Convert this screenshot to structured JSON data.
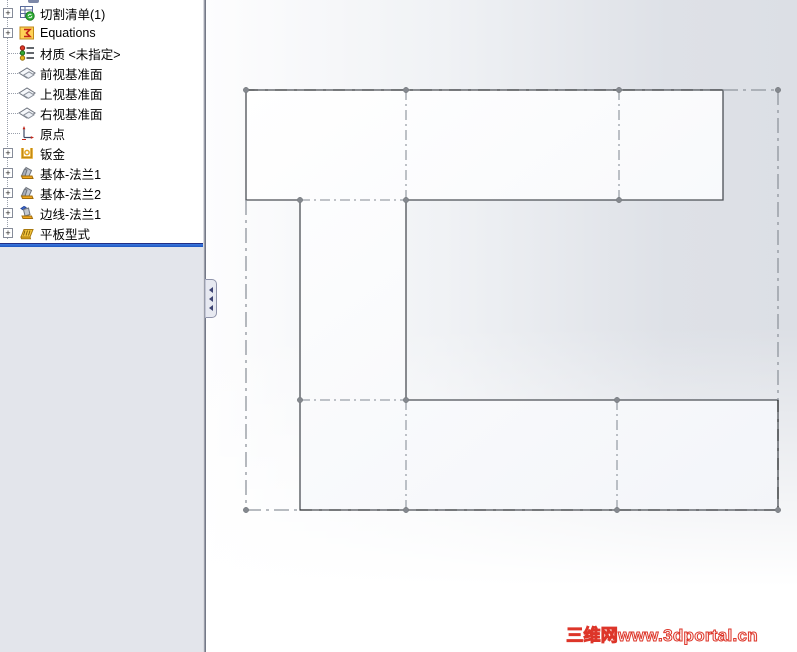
{
  "sidebar": {
    "expander_glyph": "+",
    "items": [
      {
        "label": "切割清单(1)",
        "icon": "cut-list-icon",
        "expandable": true
      },
      {
        "label": "Equations",
        "icon": "equations-icon",
        "expandable": true
      },
      {
        "label": "材质 <未指定>",
        "icon": "material-icon",
        "expandable": false
      },
      {
        "label": "前视基准面",
        "icon": "plane-icon",
        "expandable": false
      },
      {
        "label": "上视基准面",
        "icon": "plane-icon",
        "expandable": false
      },
      {
        "label": "右视基准面",
        "icon": "plane-icon",
        "expandable": false
      },
      {
        "label": "原点",
        "icon": "origin-icon",
        "expandable": false
      },
      {
        "label": "钣金",
        "icon": "sheet-metal-icon",
        "expandable": true
      },
      {
        "label": "基体-法兰1",
        "icon": "base-flange-icon",
        "expandable": true
      },
      {
        "label": "基体-法兰2",
        "icon": "base-flange-icon",
        "expandable": true
      },
      {
        "label": "边线-法兰1",
        "icon": "edge-flange-icon",
        "expandable": true
      },
      {
        "label": "平板型式",
        "icon": "flat-pattern-icon",
        "expandable": true
      }
    ]
  },
  "viewport": {
    "watermark": "三维网www.3dportal.cn"
  },
  "colors": {
    "rollback_blue": "#2a68d3",
    "edge": "#4b4f55",
    "bend_line": "#9ba1a9",
    "bounding_box": "#8f959d",
    "vertex": "#84888e",
    "watermark_red": "#dd3529",
    "lower_pane": "#e3e5eb"
  }
}
